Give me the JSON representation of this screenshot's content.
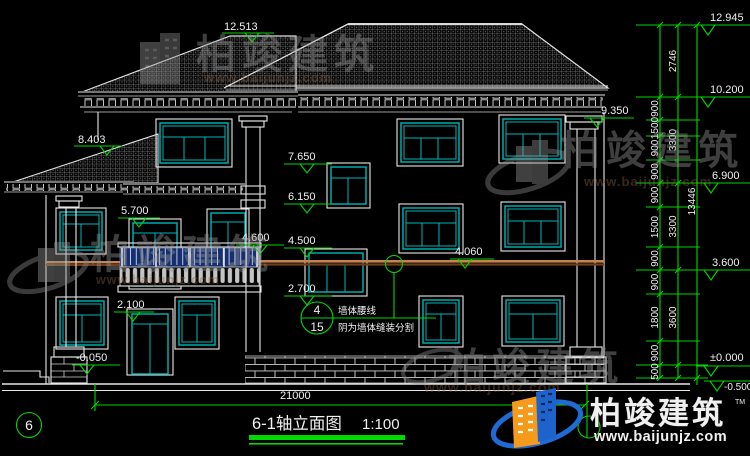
{
  "drawing": {
    "title": "6-1轴立面图",
    "scale": "1:100",
    "axis_label": "6",
    "overall_width_dim": "21000"
  },
  "elevation_markers_left": [
    "12.513",
    "8.403",
    "9.350",
    "7.650",
    "6.150",
    "5.700",
    "4.600",
    "4.500",
    "4.060",
    "2.700",
    "2.100",
    "-0.050"
  ],
  "elevation_markers_right": [
    "12.945",
    "10.200",
    "6.900",
    "3.600",
    "±0.000",
    "-0.500"
  ],
  "dimension_chain": {
    "segments": [
      "2746",
      "900",
      "1500",
      "900",
      "900",
      "900",
      "1500",
      "900",
      "900",
      "1800",
      "900",
      "500"
    ],
    "groups": [
      "3300",
      "3300",
      "3600"
    ],
    "overall": "13446"
  },
  "detail_note": {
    "detail_number": "4",
    "sheet_number": "15",
    "line1": "墙体腰线",
    "line2": "阴为墙体缝装分割"
  },
  "brand": {
    "name": "柏竣建筑",
    "website": "www.baijunjz.com",
    "trademark": "TM"
  },
  "colors": {
    "background": "#000000",
    "line_white": "#e8e8e8",
    "dim_green": "#00d800",
    "window_cyan": "#00b8b8",
    "waistline_light": "#c8824b",
    "waistline_dark": "#6e3c1e",
    "railing_navy": "#162f6e",
    "logo_blue": "#1e6bd6",
    "logo_orange": "#f59a1a"
  }
}
